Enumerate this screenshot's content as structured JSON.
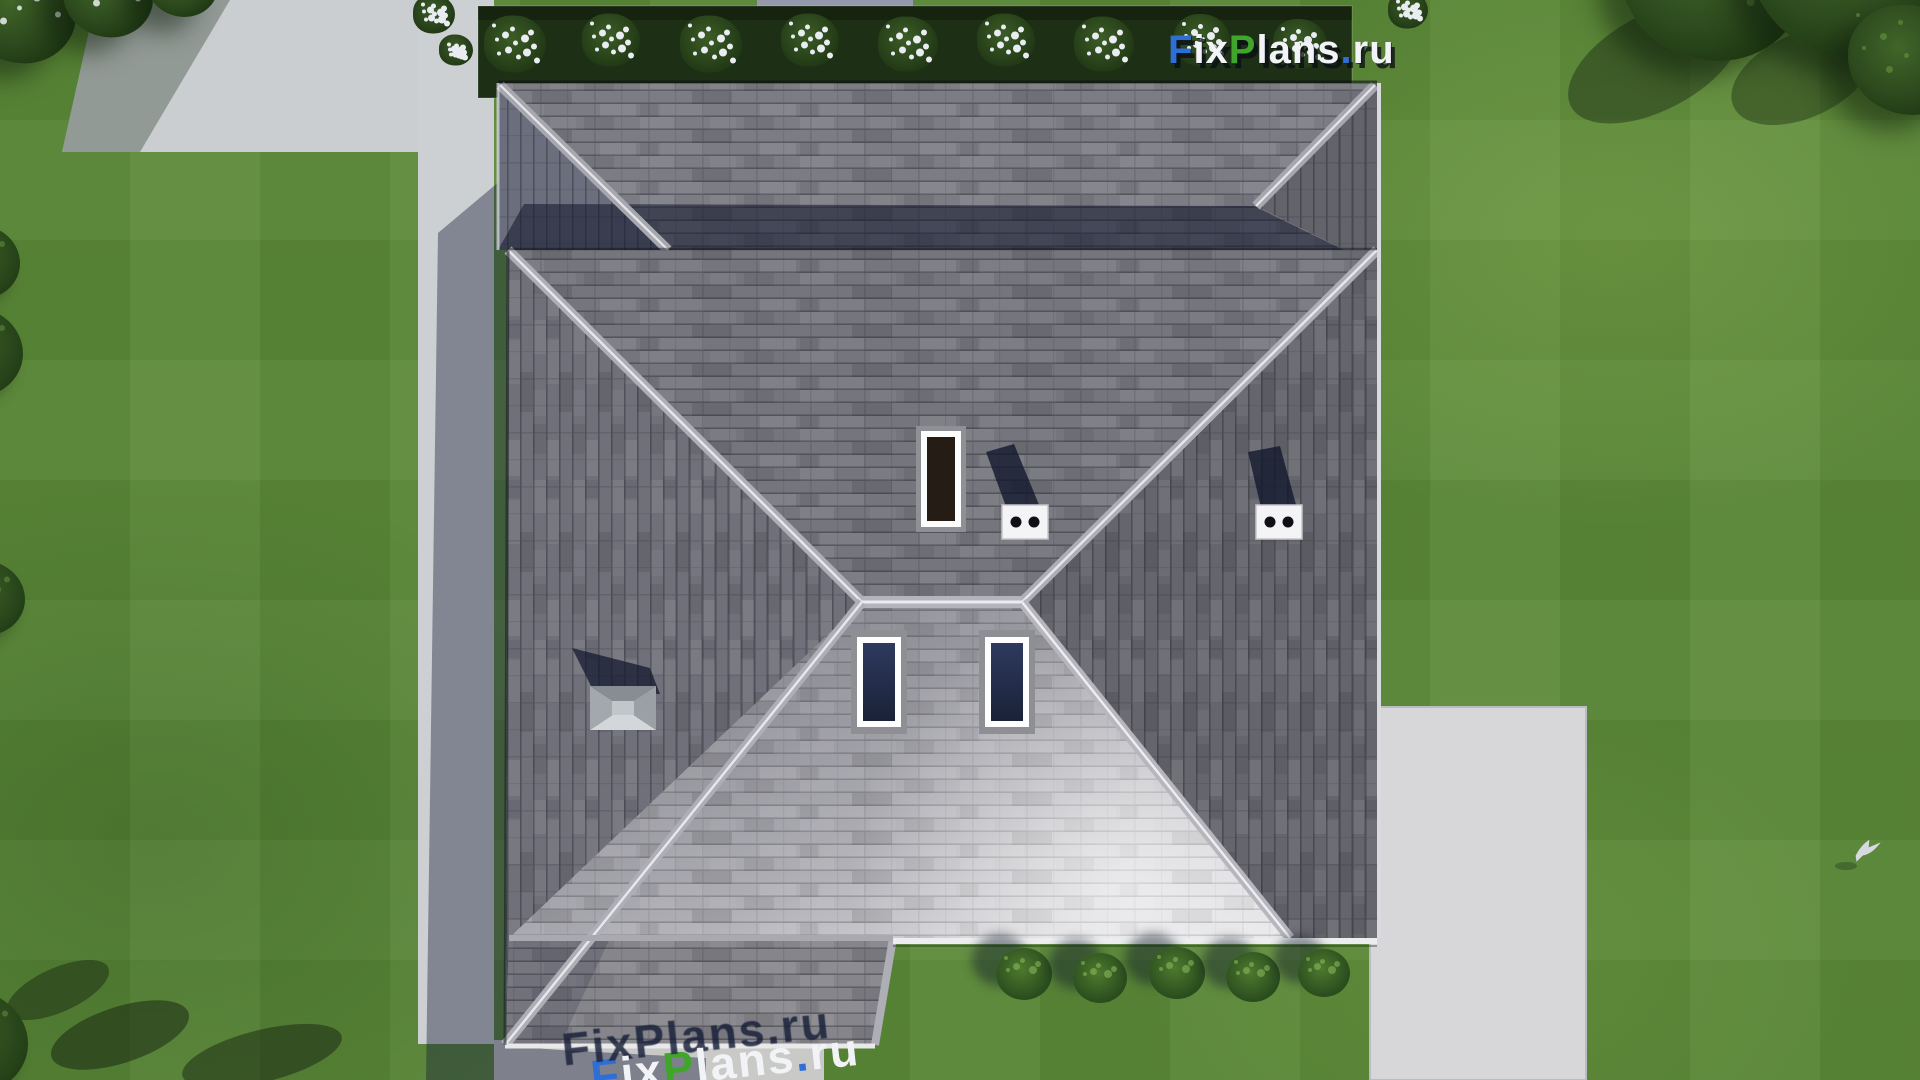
{
  "scene": {
    "description": "Aerial top-down 3D architectural render of a house with a gray shingled hip roof, surrounded by a green lawn, concrete walkways, a rear flower bed with white flowering shrubs, trees in the corners and a large concrete patio at the lower right.",
    "light": "low sun from the lower right; shadows fall toward the upper left and the house casts a long shadow to the left"
  },
  "logo": {
    "text": "FixPlans.ru",
    "parts": [
      {
        "text": "F",
        "color": "#2e6fd6"
      },
      {
        "text": "ix",
        "color": "#f2f3f7"
      },
      {
        "text": "P",
        "color": "#3fa52b"
      },
      {
        "text": "lans",
        "color": "#f2f3f7"
      },
      {
        "text": ".",
        "color": "#2e6fd6"
      },
      {
        "text": "ru",
        "color": "#f2f3f7"
      }
    ]
  },
  "watermark_bottom": {
    "text": "FixPlans.ru",
    "note_visible": "letter tops only, cut off by bottom edge, standing on driveway with long shadows"
  },
  "palette": {
    "grass_base": "#5c8a39",
    "grass_dark": "#4a762e",
    "bed_green": "#1d2f15",
    "tree_green": "#2d4b1e",
    "flower_white": "#e9edf2",
    "concrete_light": "#cdd0d2",
    "concrete_patio": "#d7d7d9",
    "concrete_shadowed": "#949aac",
    "roof_north": "#75757d",
    "roof_east": "#65656d",
    "roof_west": "#70707a",
    "roof_back_wing": "#7c7c84",
    "roof_south_bright": "#dcdce0",
    "roof_extension": "#85858b",
    "ridge_cap": "#b0b0b8",
    "fascia_light": "#ecedee",
    "shadow_navy": "#141c2c",
    "skylight_glass": "#25304f",
    "skylight_frame": "#fdfdfe",
    "chimney_glass_dark": "#251c15"
  },
  "objects": {
    "flower_bushes": [
      {
        "x": 515,
        "y": 44,
        "s": 62
      },
      {
        "x": 611,
        "y": 40,
        "s": 58
      },
      {
        "x": 711,
        "y": 44,
        "s": 62
      },
      {
        "x": 810,
        "y": 40,
        "s": 58
      },
      {
        "x": 908,
        "y": 44,
        "s": 60
      },
      {
        "x": 1006,
        "y": 40,
        "s": 58
      },
      {
        "x": 1104,
        "y": 44,
        "s": 60
      },
      {
        "x": 1202,
        "y": 40,
        "s": 56
      },
      {
        "x": 1300,
        "y": 44,
        "s": 54
      },
      {
        "x": 434,
        "y": 14,
        "s": 42
      },
      {
        "x": 456,
        "y": 50,
        "s": 34
      },
      {
        "x": 1408,
        "y": 10,
        "s": 40
      }
    ],
    "hedge_bushes": [
      {
        "x": 1024,
        "y": 974,
        "s": 56
      },
      {
        "x": 1100,
        "y": 978,
        "s": 54
      },
      {
        "x": 1177,
        "y": 973,
        "s": 56
      },
      {
        "x": 1253,
        "y": 977,
        "s": 54
      },
      {
        "x": 1324,
        "y": 973,
        "s": 52
      }
    ],
    "left_bushes": [
      {
        "x": -20,
        "y": 262,
        "s": 80
      },
      {
        "x": -26,
        "y": 352,
        "s": 98
      },
      {
        "x": -16,
        "y": 598,
        "s": 82
      },
      {
        "x": -28,
        "y": 1042,
        "s": 112
      }
    ],
    "corner_trees_top_left": [
      {
        "x": 20,
        "y": 12,
        "s": 112
      },
      {
        "x": 108,
        "y": -4,
        "s": 90
      },
      {
        "x": 182,
        "y": -16,
        "s": 72
      }
    ],
    "trees_top_right": [
      {
        "x": 1712,
        "y": -24,
        "s": 185
      },
      {
        "x": 1852,
        "y": -36,
        "s": 205
      },
      {
        "x": 1908,
        "y": 60,
        "s": 120
      }
    ],
    "roof_features": [
      {
        "name": "chimney-skylight-dark",
        "x": 916,
        "y": 426,
        "w": 50,
        "h": 106
      },
      {
        "name": "roof-vent-two-holes",
        "x": 1002,
        "y": 505,
        "w": 46,
        "h": 34
      },
      {
        "name": "roof-vent-two-holes",
        "x": 1256,
        "y": 505,
        "w": 46,
        "h": 34
      },
      {
        "name": "pyramid-roof-vent",
        "x": 590,
        "y": 686,
        "w": 66,
        "h": 44
      },
      {
        "name": "skylight-navy",
        "x": 851,
        "y": 630,
        "w": 56,
        "h": 104
      },
      {
        "name": "skylight-navy",
        "x": 979,
        "y": 630,
        "w": 56,
        "h": 104
      }
    ],
    "bird": {
      "x": 1852,
      "y": 845
    }
  }
}
